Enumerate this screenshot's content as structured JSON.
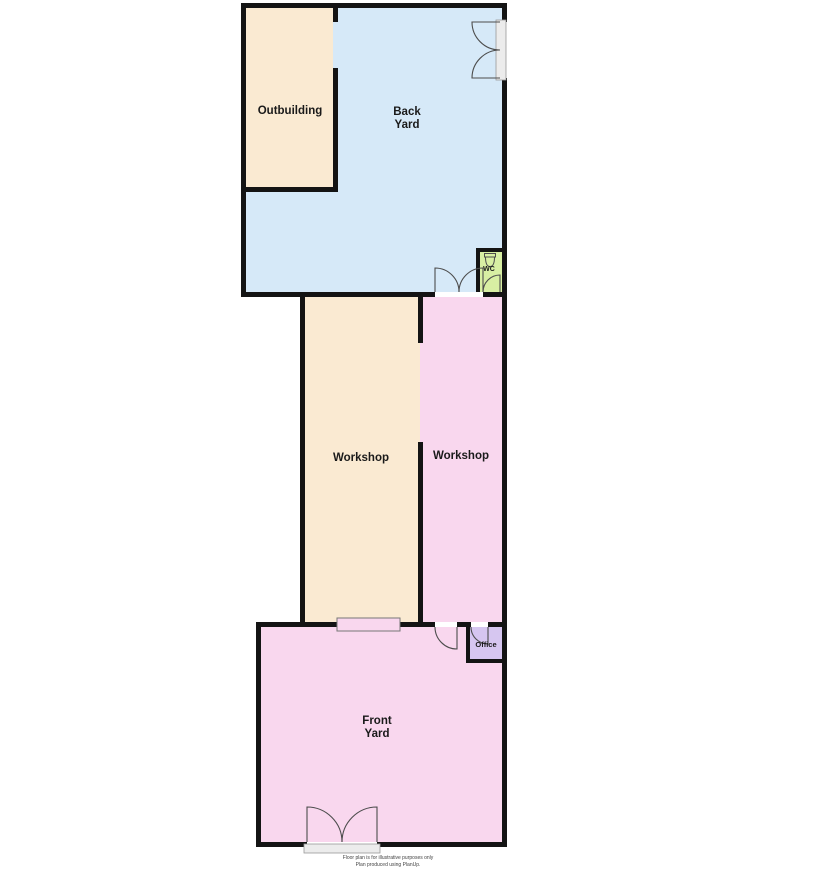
{
  "rooms": {
    "outbuilding": {
      "label": "Outbuilding",
      "color": "#FAEAD2"
    },
    "back_yard": {
      "line1": "Back",
      "line2": "Yard",
      "color": "#D6E9F8"
    },
    "workshop_left": {
      "label": "Workshop",
      "color": "#FAEAD2"
    },
    "workshop_right": {
      "label": "Workshop",
      "color": "#F9D7EE"
    },
    "wc": {
      "label": "WC",
      "color": "#D8EFA3"
    },
    "office": {
      "label": "Office",
      "color": "#D6C6F0"
    },
    "front_yard": {
      "line1": "Front",
      "line2": "Yard",
      "color": "#F9D7EE"
    }
  },
  "footer": {
    "line1": "Floor plan is for illustrative purposes only",
    "line2": "Plan produced using PlanUp."
  },
  "colors": {
    "wall": "#141414",
    "door_stroke": "#4d4d4d",
    "window_stroke": "#777777",
    "background": "#ffffff"
  }
}
